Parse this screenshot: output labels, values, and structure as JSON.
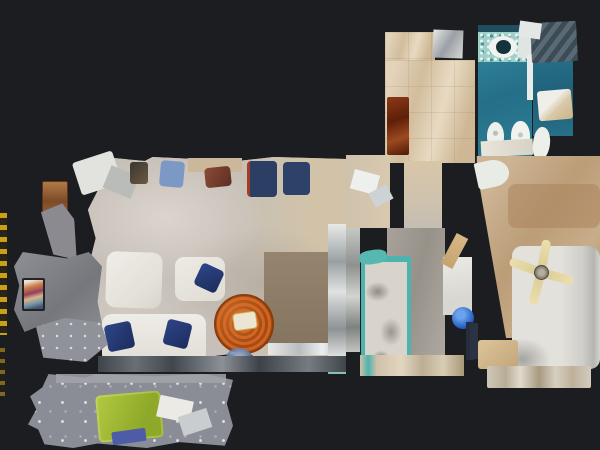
{
  "scene": {
    "description": "Top-down dollhouse view of a 3D-scanned apartment on a dark background",
    "background_color": "#1b1d20"
  },
  "rooms": [
    {
      "name": "living-room",
      "floor_color": "#c9c3bb",
      "furniture": [
        {
          "name": "tv",
          "color": "#232325"
        },
        {
          "name": "tv-stand",
          "color": "#84858b"
        },
        {
          "name": "wood-cabinet",
          "color": "#9c6840"
        },
        {
          "name": "desk-chair-blue",
          "color": "#7b99c4"
        },
        {
          "name": "desk",
          "color": "#cbb89b"
        },
        {
          "name": "chair-red",
          "color": "#7e4233"
        },
        {
          "name": "dining-chair-navy-1",
          "color": "#2c3e64"
        },
        {
          "name": "dining-chair-navy-2",
          "color": "#2e4168"
        },
        {
          "name": "armchair-1",
          "color": "#ebe9e3"
        },
        {
          "name": "armchair-2",
          "color": "#e9e7e0"
        },
        {
          "name": "sofa",
          "color": "#e8e6df"
        },
        {
          "name": "throw-pillows",
          "color": "#253a72"
        },
        {
          "name": "coffee-table-round",
          "color": "#c05a1e"
        },
        {
          "name": "area-rug",
          "color": "#8d7c6a"
        }
      ]
    },
    {
      "name": "hallway",
      "floor_color": "#d9c6a9",
      "furniture": [
        {
          "name": "runner-rug",
          "color": "#7a2d12"
        }
      ]
    },
    {
      "name": "bathroom",
      "floor_color": "#2d7e96",
      "furniture": [
        {
          "name": "mosaic-counter",
          "color": "#9fcfc9"
        },
        {
          "name": "sink",
          "color": "#f0f2ef"
        },
        {
          "name": "toilet",
          "color": "#eef0ec"
        },
        {
          "name": "bidet",
          "color": "#f1f3ef"
        }
      ]
    },
    {
      "name": "shower-room",
      "floor_color": "#236a82",
      "furniture": [
        {
          "name": "glass-shower",
          "color": "#4e5f6b"
        },
        {
          "name": "vanity",
          "color": "#d9c9a8"
        },
        {
          "name": "toilet",
          "color": "#edefeb"
        }
      ]
    },
    {
      "name": "bedroom",
      "floor_color": "#a49e96",
      "furniture": [
        {
          "name": "bed-teal-frame",
          "color": "#4db3ae"
        },
        {
          "name": "mattress",
          "color": "#d8d4cc"
        },
        {
          "name": "wardrobe",
          "color": "#eceae5"
        },
        {
          "name": "blue-stool",
          "color": "#2257c0"
        }
      ]
    },
    {
      "name": "master-bedroom",
      "floor_color": "#c1a584",
      "furniture": [
        {
          "name": "double-bed",
          "color": "#dedcd6"
        },
        {
          "name": "ceiling-fan",
          "color": "#e6d9a5"
        },
        {
          "name": "nightstand",
          "color": "#d5bb8e"
        },
        {
          "name": "bench",
          "color": "#cfc8b9"
        }
      ]
    },
    {
      "name": "terrace",
      "floor_color": "#8b8d96",
      "furniture": [
        {
          "name": "sun-lounger",
          "color": "#a3bb36"
        },
        {
          "name": "side-table",
          "color": "#eceae4"
        }
      ]
    }
  ]
}
